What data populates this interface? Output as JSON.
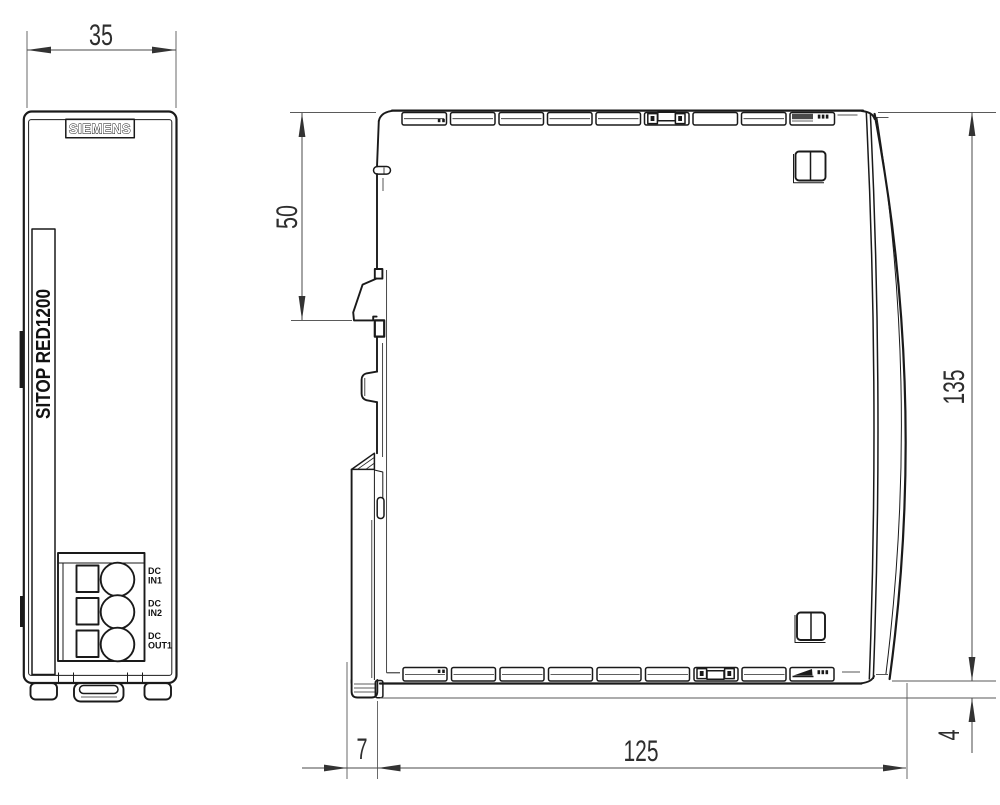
{
  "drawing": {
    "type": "technical-dimension-drawing",
    "product": {
      "brand": "SIEMENS",
      "model": "SITOP RED1200"
    },
    "views": {
      "front": {
        "label": "front view",
        "dimensions": {
          "width_mm": "35"
        },
        "terminals": [
          {
            "line1": "DC",
            "line2": "IN1"
          },
          {
            "line1": "DC",
            "line2": "IN2"
          },
          {
            "line1": "DC",
            "line2": "OUT1"
          }
        ]
      },
      "side": {
        "label": "side view",
        "dimensions": {
          "top_to_din_rail_mm": "50",
          "height_mm": "135",
          "latch_extension_mm": "7",
          "depth_mm": "125",
          "latch_protrusion_mm": "4"
        }
      }
    },
    "colors": {
      "line": "#1a1a1a",
      "dimension": "#4a4a4a",
      "background": "#ffffff"
    }
  }
}
